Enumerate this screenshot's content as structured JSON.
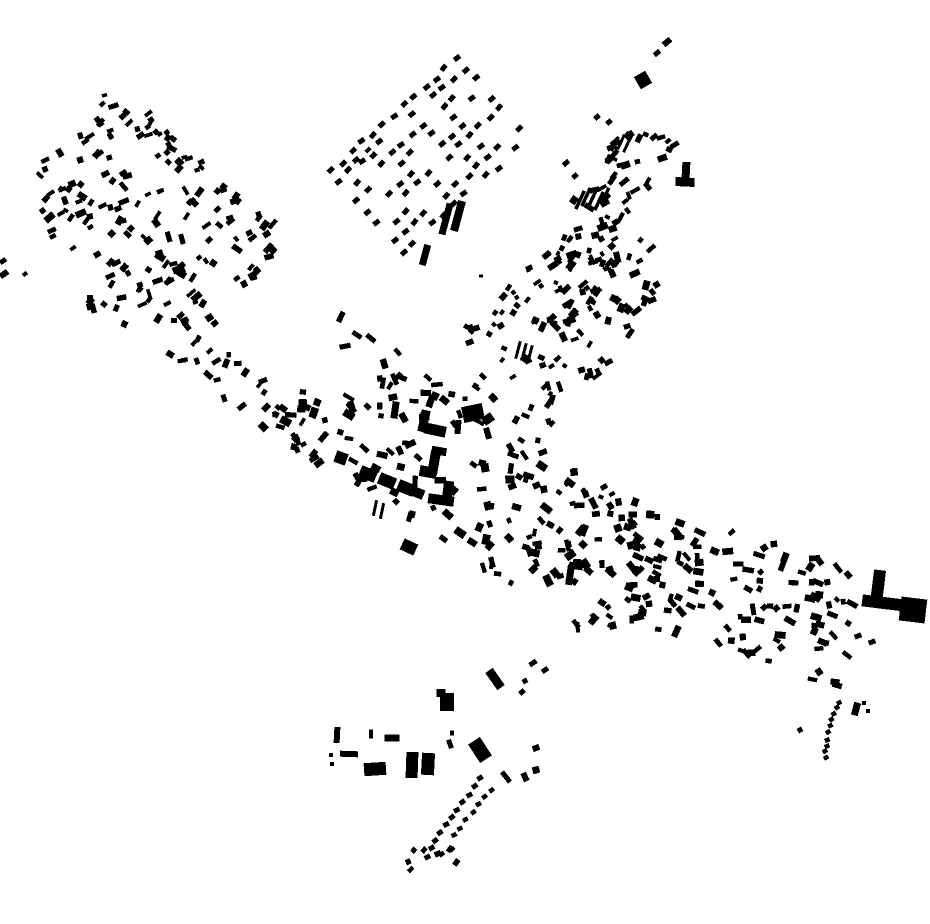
{
  "meta": {
    "width": 930,
    "height": 924,
    "background": "#ffffff",
    "ink": "#000000"
  },
  "map": {
    "structures": [
      {
        "name": "plaza-north-range",
        "rects": [
          [
            424,
            421,
            9,
            22,
            12
          ],
          [
            435,
            430,
            22,
            11,
            12
          ],
          [
            395,
            410,
            7,
            17,
            8
          ],
          [
            458,
            427,
            6,
            14,
            5
          ]
        ]
      },
      {
        "name": "plaza-northeast-block",
        "rects": [
          [
            473,
            413,
            21,
            16,
            -12
          ],
          [
            488,
            419,
            11,
            9,
            -35
          ]
        ]
      },
      {
        "name": "plaza-east-building",
        "rects": [
          [
            439,
            451,
            15,
            8,
            10
          ],
          [
            434,
            463,
            10,
            24,
            10
          ],
          [
            428,
            472,
            17,
            11,
            10
          ]
        ]
      },
      {
        "name": "plaza-south-range",
        "rects": [
          [
            448,
            490,
            10,
            18,
            8
          ],
          [
            441,
            500,
            26,
            10,
            8
          ]
        ]
      },
      {
        "name": "plaza-west-range",
        "rects": [
          [
            341,
            458,
            12,
            12,
            20
          ],
          [
            368,
            474,
            17,
            12,
            22
          ],
          [
            387,
            481,
            17,
            12,
            22
          ],
          [
            406,
            488,
            17,
            12,
            22
          ],
          [
            418,
            493,
            12,
            10,
            22
          ]
        ]
      },
      {
        "name": "orchard-bars",
        "rects": [
          [
            446,
            219,
            7,
            32,
            15
          ],
          [
            458,
            216,
            8,
            31,
            15
          ],
          [
            425,
            255,
            7,
            21,
            15
          ]
        ]
      },
      {
        "name": "t-shaped-building",
        "rects": [
          [
            686,
            170,
            8,
            16,
            3
          ],
          [
            685,
            182,
            19,
            9,
            3
          ]
        ]
      },
      {
        "name": "east-l-building",
        "rects": [
          [
            878,
            587,
            12,
            34,
            7
          ],
          [
            884,
            603,
            44,
            12,
            7
          ],
          [
            913,
            610,
            26,
            24,
            7
          ]
        ]
      },
      {
        "name": "northeast-wedge",
        "rects": [
          [
            643,
            80,
            13,
            14,
            -30
          ]
        ]
      },
      {
        "name": "northeast-dashes",
        "rects": [
          [
            667,
            42,
            9,
            6,
            -40
          ],
          [
            657,
            53,
            7,
            5,
            -40
          ],
          [
            597,
            117,
            6,
            5,
            -40
          ],
          [
            609,
            122,
            6,
            5,
            -40
          ],
          [
            654,
            137,
            8,
            5,
            -40
          ],
          [
            668,
            141,
            6,
            4,
            -40
          ],
          [
            566,
            163,
            7,
            5,
            -40
          ],
          [
            575,
            176,
            6,
            5,
            -40
          ]
        ]
      },
      {
        "name": "slash-group-upper",
        "rects": [
          [
            615,
            144,
            3,
            16,
            25
          ],
          [
            621,
            142,
            3,
            16,
            25
          ],
          [
            627,
            145,
            3,
            16,
            25
          ]
        ]
      },
      {
        "name": "slash-group-main",
        "rects": [
          [
            580,
            200,
            3.5,
            20,
            25
          ],
          [
            586,
            197,
            3.5,
            20,
            25
          ],
          [
            592,
            199,
            3.5,
            20,
            25
          ],
          [
            599,
            201,
            3.5,
            20,
            25
          ],
          [
            605,
            196,
            3.5,
            18,
            25
          ]
        ]
      },
      {
        "name": "slash-group-center",
        "rects": [
          [
            518,
            350,
            3,
            18,
            15
          ],
          [
            524,
            352,
            3,
            18,
            15
          ],
          [
            530,
            354,
            3,
            18,
            15
          ]
        ]
      },
      {
        "name": "slash-group-plaza-south",
        "rects": [
          [
            375,
            508,
            3,
            16,
            12
          ],
          [
            382,
            511,
            3,
            16,
            12
          ]
        ]
      },
      {
        "name": "south-corner-building",
        "rects": [
          [
            570,
            575,
            7,
            20,
            8
          ],
          [
            576,
            566,
            14,
            7,
            8
          ]
        ]
      },
      {
        "name": "center-south-block",
        "rects": [
          [
            409,
            547,
            15,
            12,
            25
          ]
        ]
      },
      {
        "name": "mid-east-dashes",
        "rects": [
          [
            604,
            487,
            7,
            5,
            -30
          ],
          [
            612,
            494,
            6,
            4,
            -30
          ],
          [
            601,
            497,
            5,
            4,
            20
          ]
        ]
      },
      {
        "name": "grid-northwest-dots",
        "rects": [
          [
            356,
            160,
            7,
            5,
            -42
          ],
          [
            368,
            150,
            6,
            4,
            -42
          ]
        ]
      },
      {
        "name": "bottom-row-west",
        "rects": [
          [
            337,
            735,
            6,
            16,
            3
          ],
          [
            371,
            734,
            4,
            9,
            2
          ],
          [
            392,
            738,
            15,
            7,
            0
          ],
          [
            349,
            754,
            18,
            6,
            2
          ],
          [
            331,
            755,
            4,
            4,
            0
          ],
          [
            332,
            764,
            4,
            4,
            0
          ]
        ]
      },
      {
        "name": "bottom-blocks",
        "rects": [
          [
            375,
            769,
            22,
            13,
            -4
          ],
          [
            412,
            765,
            12,
            26,
            2
          ],
          [
            428,
            764,
            13,
            22,
            3
          ],
          [
            452,
            733,
            4,
            5,
            0
          ],
          [
            450,
            744,
            5,
            9,
            -20
          ],
          [
            441,
            693,
            9,
            8,
            0
          ],
          [
            447,
            702,
            14,
            18,
            0
          ],
          [
            480,
            750,
            14,
            22,
            -33
          ],
          [
            495,
            679,
            9,
            21,
            -35
          ]
        ]
      },
      {
        "name": "bottom-east-marks",
        "rects": [
          [
            533,
            663,
            8,
            5,
            -35
          ],
          [
            545,
            670,
            7,
            5,
            -35
          ],
          [
            525,
            681,
            5,
            5,
            -30
          ],
          [
            522,
            692,
            6,
            5,
            -40
          ],
          [
            536,
            748,
            7,
            6,
            -20
          ],
          [
            506,
            777,
            5,
            13,
            -38
          ],
          [
            525,
            777,
            6,
            9,
            -25
          ],
          [
            536,
            770,
            7,
            7,
            -15
          ]
        ]
      },
      {
        "name": "east-band-tail",
        "rects": [
          [
            858,
            636,
            7,
            5,
            -20
          ],
          [
            872,
            642,
            7,
            5,
            -20
          ]
        ]
      },
      {
        "name": "arc-side-marks",
        "rects": [
          [
            856,
            709,
            7,
            13,
            15
          ],
          [
            864,
            703,
            4,
            4,
            0
          ],
          [
            868,
            711,
            4,
            4,
            0
          ],
          [
            800,
            730,
            5,
            5,
            -30
          ]
        ]
      },
      {
        "name": "west-edge-marks",
        "rects": [
          [
            3,
            261,
            7,
            5,
            -35
          ],
          [
            4,
            274,
            9,
            6,
            -35
          ],
          [
            25,
            274,
            5,
            4,
            -35
          ]
        ]
      },
      {
        "name": "lone-dot",
        "rects": [
          [
            481,
            276,
            4,
            3,
            0
          ]
        ]
      }
    ],
    "clusters": [
      {
        "name": "cluster-left-main",
        "seed": 11,
        "axis": [
          [
            62,
            148
          ],
          [
            248,
            292
          ]
        ],
        "rows": 7,
        "pitch": 21,
        "count": 135,
        "angle": -37,
        "angleJitter": 24,
        "cross": 0.2,
        "sizeMin": [
          5,
          3.5
        ],
        "sizeMax": [
          11,
          7
        ]
      },
      {
        "name": "cluster-left-top-spur",
        "seed": 12,
        "axis": [
          [
            122,
            106
          ],
          [
            205,
            182
          ]
        ],
        "rows": 2,
        "pitch": 15,
        "count": 16,
        "angle": -38,
        "angleJitter": 22,
        "cross": 0.1,
        "sizeMin": [
          5,
          3.5
        ],
        "sizeMax": [
          9,
          6
        ]
      },
      {
        "name": "cluster-left-west-spur",
        "seed": 13,
        "axis": [
          [
            28,
            168
          ],
          [
            88,
            248
          ]
        ],
        "rows": 3,
        "pitch": 16,
        "count": 16,
        "angle": -36,
        "angleJitter": 24,
        "cross": 0.15,
        "sizeMin": [
          5,
          3.5
        ],
        "sizeMax": [
          9,
          6
        ]
      },
      {
        "name": "cluster-connector",
        "seed": 14,
        "axis": [
          [
            96,
            290
          ],
          [
            335,
            448
          ]
        ],
        "rows": 2,
        "pitch": 24,
        "count": 44,
        "angle": -35,
        "angleJitter": 38,
        "cross": 0.25,
        "sizeMin": [
          5,
          3.5
        ],
        "sizeMax": [
          10,
          6.5
        ]
      },
      {
        "name": "cluster-northeast-band",
        "seed": 15,
        "axis": [
          [
            570,
            302
          ],
          [
            600,
            200
          ],
          [
            660,
            132
          ]
        ],
        "rows": 4,
        "pitch": 15,
        "count": 70,
        "angle": -40,
        "angleJitter": 30,
        "cross": 0.25,
        "sizeMin": [
          4,
          3.5
        ],
        "sizeMax": [
          11,
          7
        ]
      },
      {
        "name": "cluster-junction",
        "seed": 16,
        "axis": [
          [
            648,
            240
          ],
          [
            505,
            420
          ]
        ],
        "rows": 6,
        "pitch": 16,
        "count": 90,
        "angle": -45,
        "angleJitter": 32,
        "cross": 0.3,
        "sizeMin": [
          4,
          3.5
        ],
        "sizeMax": [
          11,
          7
        ]
      },
      {
        "name": "cluster-center-main",
        "seed": 17,
        "axis": [
          [
            298,
            368
          ],
          [
            658,
            598
          ]
        ],
        "rows": 9,
        "pitch": 16,
        "count": 200,
        "angle": 32,
        "angleJitter": 45,
        "cross": 0.3,
        "sizeMin": [
          5,
          4
        ],
        "sizeMax": [
          12,
          8
        ],
        "exclude": [
          [
            420,
            424,
            50,
            48
          ]
        ]
      },
      {
        "name": "cluster-east-band",
        "seed": 18,
        "axis": [
          [
            618,
            560
          ],
          [
            740,
            592
          ],
          [
            856,
            634
          ]
        ],
        "rows": 8,
        "pitch": 15,
        "count": 115,
        "angle": 22,
        "angleJitter": 35,
        "cross": 0.25,
        "sizeMin": [
          5,
          4
        ],
        "sizeMax": [
          12,
          7
        ]
      },
      {
        "name": "cluster-mini-north-a",
        "seed": 19,
        "axis": [
          [
            505,
            305
          ],
          [
            560,
            255
          ]
        ],
        "rows": 2,
        "pitch": 14,
        "count": 14,
        "angle": -40,
        "angleJitter": 25,
        "cross": 0.2,
        "sizeMin": [
          4,
          3.5
        ],
        "sizeMax": [
          9,
          6
        ]
      },
      {
        "name": "cluster-mini-north-b",
        "seed": 20,
        "axis": [
          [
            462,
            340
          ],
          [
            510,
            310
          ]
        ],
        "rows": 2,
        "pitch": 13,
        "count": 10,
        "angle": -40,
        "angleJitter": 25,
        "cross": 0.2,
        "sizeMin": [
          4,
          3.5
        ],
        "sizeMax": [
          9,
          6
        ]
      }
    ],
    "grid": {
      "name": "orchard-grid",
      "seed": 21,
      "origin": [
        331,
        171
      ],
      "angle": -42,
      "cols": 13,
      "colPitch": 14,
      "rows": 9,
      "rowPitch": 13.5,
      "fill": 0.66,
      "dot": [
        7,
        5
      ],
      "angleJitter": 9,
      "posJitter": 2.5
    },
    "chains": [
      {
        "name": "trail-dotted-a",
        "seed": 23,
        "points": [
          [
            481,
            779
          ],
          [
            460,
            806
          ],
          [
            441,
            831
          ],
          [
            426,
            857
          ]
        ],
        "spacing": 9.5,
        "dot": [
          6,
          5
        ],
        "angle": -32
      },
      {
        "name": "trail-dotted-b",
        "seed": 24,
        "points": [
          [
            492,
            789
          ],
          [
            470,
            815
          ],
          [
            452,
            838
          ]
        ],
        "spacing": 10,
        "dot": [
          5.5,
          4.5
        ],
        "angle": -32
      },
      {
        "name": "southeast-dotted-arc",
        "seed": 25,
        "points": [
          [
            839,
            702
          ],
          [
            833,
            716
          ],
          [
            829,
            731
          ],
          [
            826,
            746
          ],
          [
            826,
            762
          ]
        ],
        "spacing": 6.5,
        "dot": [
          5,
          4.5
        ],
        "angle": -28
      }
    ],
    "scatters": [
      {
        "name": "trail-end-scatter",
        "seed": 22,
        "bbox": [
          408,
          845,
          54,
          39
        ],
        "count": 9,
        "angle": -30,
        "angleJitter": 25,
        "sizeMin": [
          5,
          4
        ],
        "sizeMax": [
          8,
          6
        ]
      }
    ]
  }
}
